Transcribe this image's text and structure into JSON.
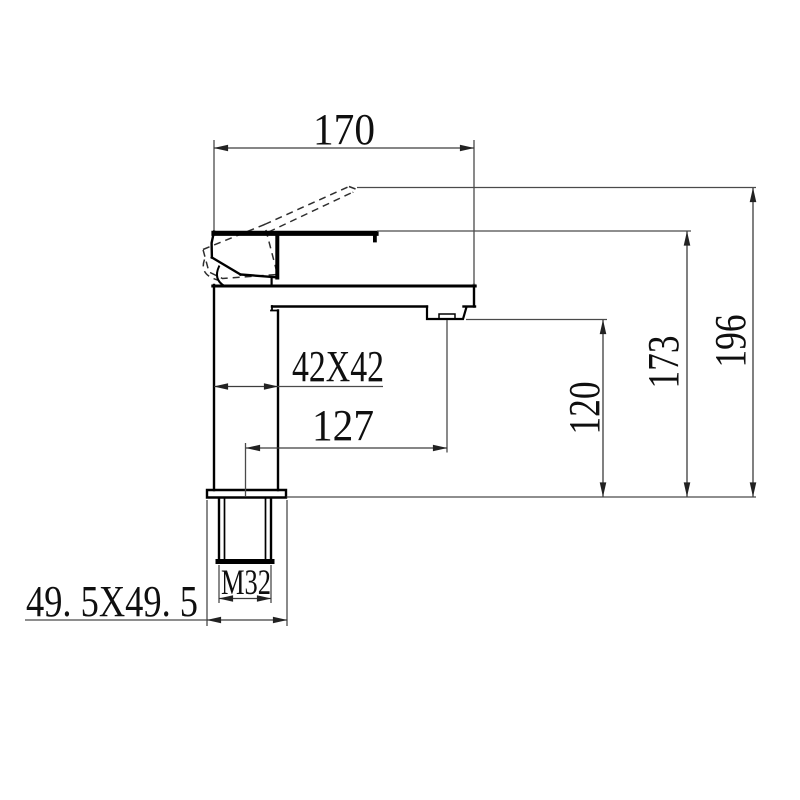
{
  "labels": {
    "spout_width": "170",
    "body_cross_section": "42X42",
    "outlet_offset": "127",
    "thread_size": "M32",
    "base_cross_section": "49. 5X49. 5",
    "outlet_height": "120",
    "spout_height": "173",
    "overall_height": "196"
  },
  "colors": {
    "background": "#ffffff",
    "object_line": "#000000",
    "dimension_line": "#3d3d3d",
    "text": "#0f0f0f"
  }
}
